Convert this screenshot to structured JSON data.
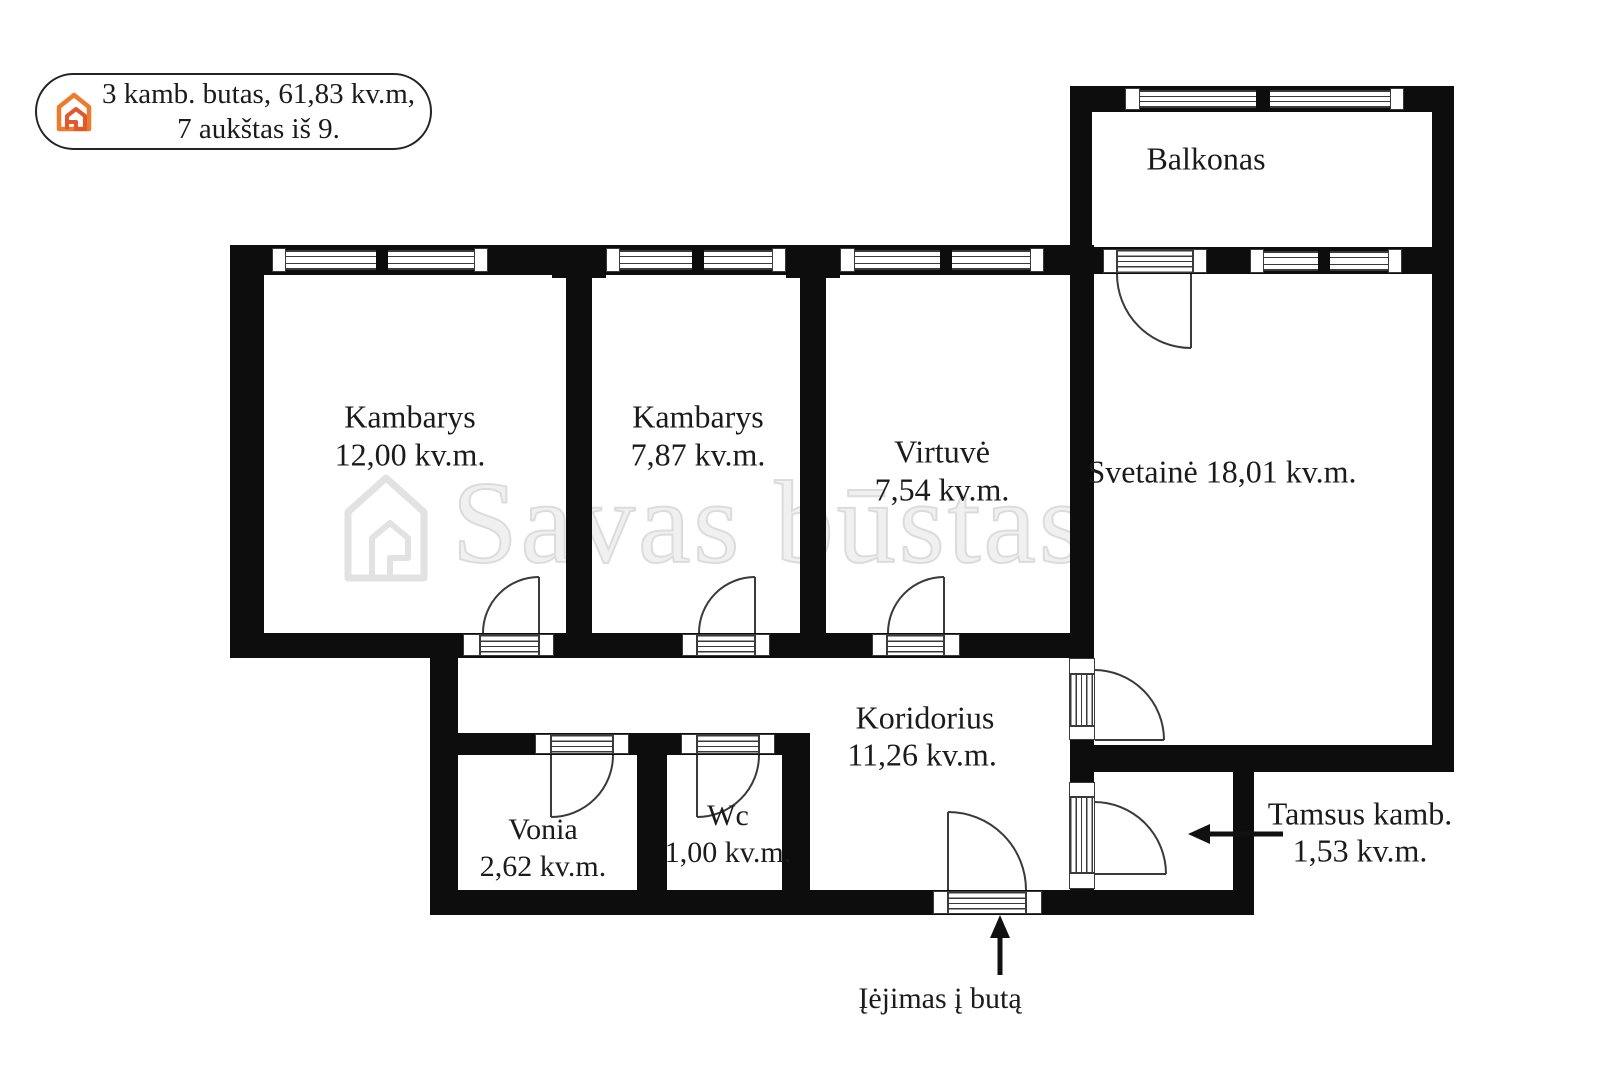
{
  "badge": {
    "line1": "3 kamb. butas, 61,83 kv.m,",
    "line2": "7 aukštas iš 9.",
    "icon": "house-icon",
    "accent_color": "#ec7c2d"
  },
  "watermark": {
    "text": "Savas būstas",
    "icon": "house-outline-icon",
    "color": "#ececec"
  },
  "rooms": {
    "balkonas": {
      "name": "Balkonas"
    },
    "kambarys1": {
      "name": "Kambarys",
      "area": "12,00 kv.m."
    },
    "kambarys2": {
      "name": "Kambarys",
      "area": "7,87 kv.m."
    },
    "virtuve": {
      "name": "Virtuvė",
      "area": "7,54 kv.m."
    },
    "svetaine": {
      "label": "Svetainė 18,01 kv.m."
    },
    "koridorius": {
      "name": "Koridorius",
      "area": "11,26 kv.m."
    },
    "vonia": {
      "name": "Vonia",
      "area": "2,62 kv.m."
    },
    "wc": {
      "name": "Wc",
      "area": "1,00 kv.m."
    },
    "tamsus": {
      "name": "Tamsus kamb.",
      "area": "1,53 kv.m."
    }
  },
  "annotations": {
    "entrance": "Įėjimas į butą"
  },
  "colors": {
    "wall": "#0d0d0d",
    "line": "#3a3a3a",
    "text": "#1b1b1b"
  }
}
